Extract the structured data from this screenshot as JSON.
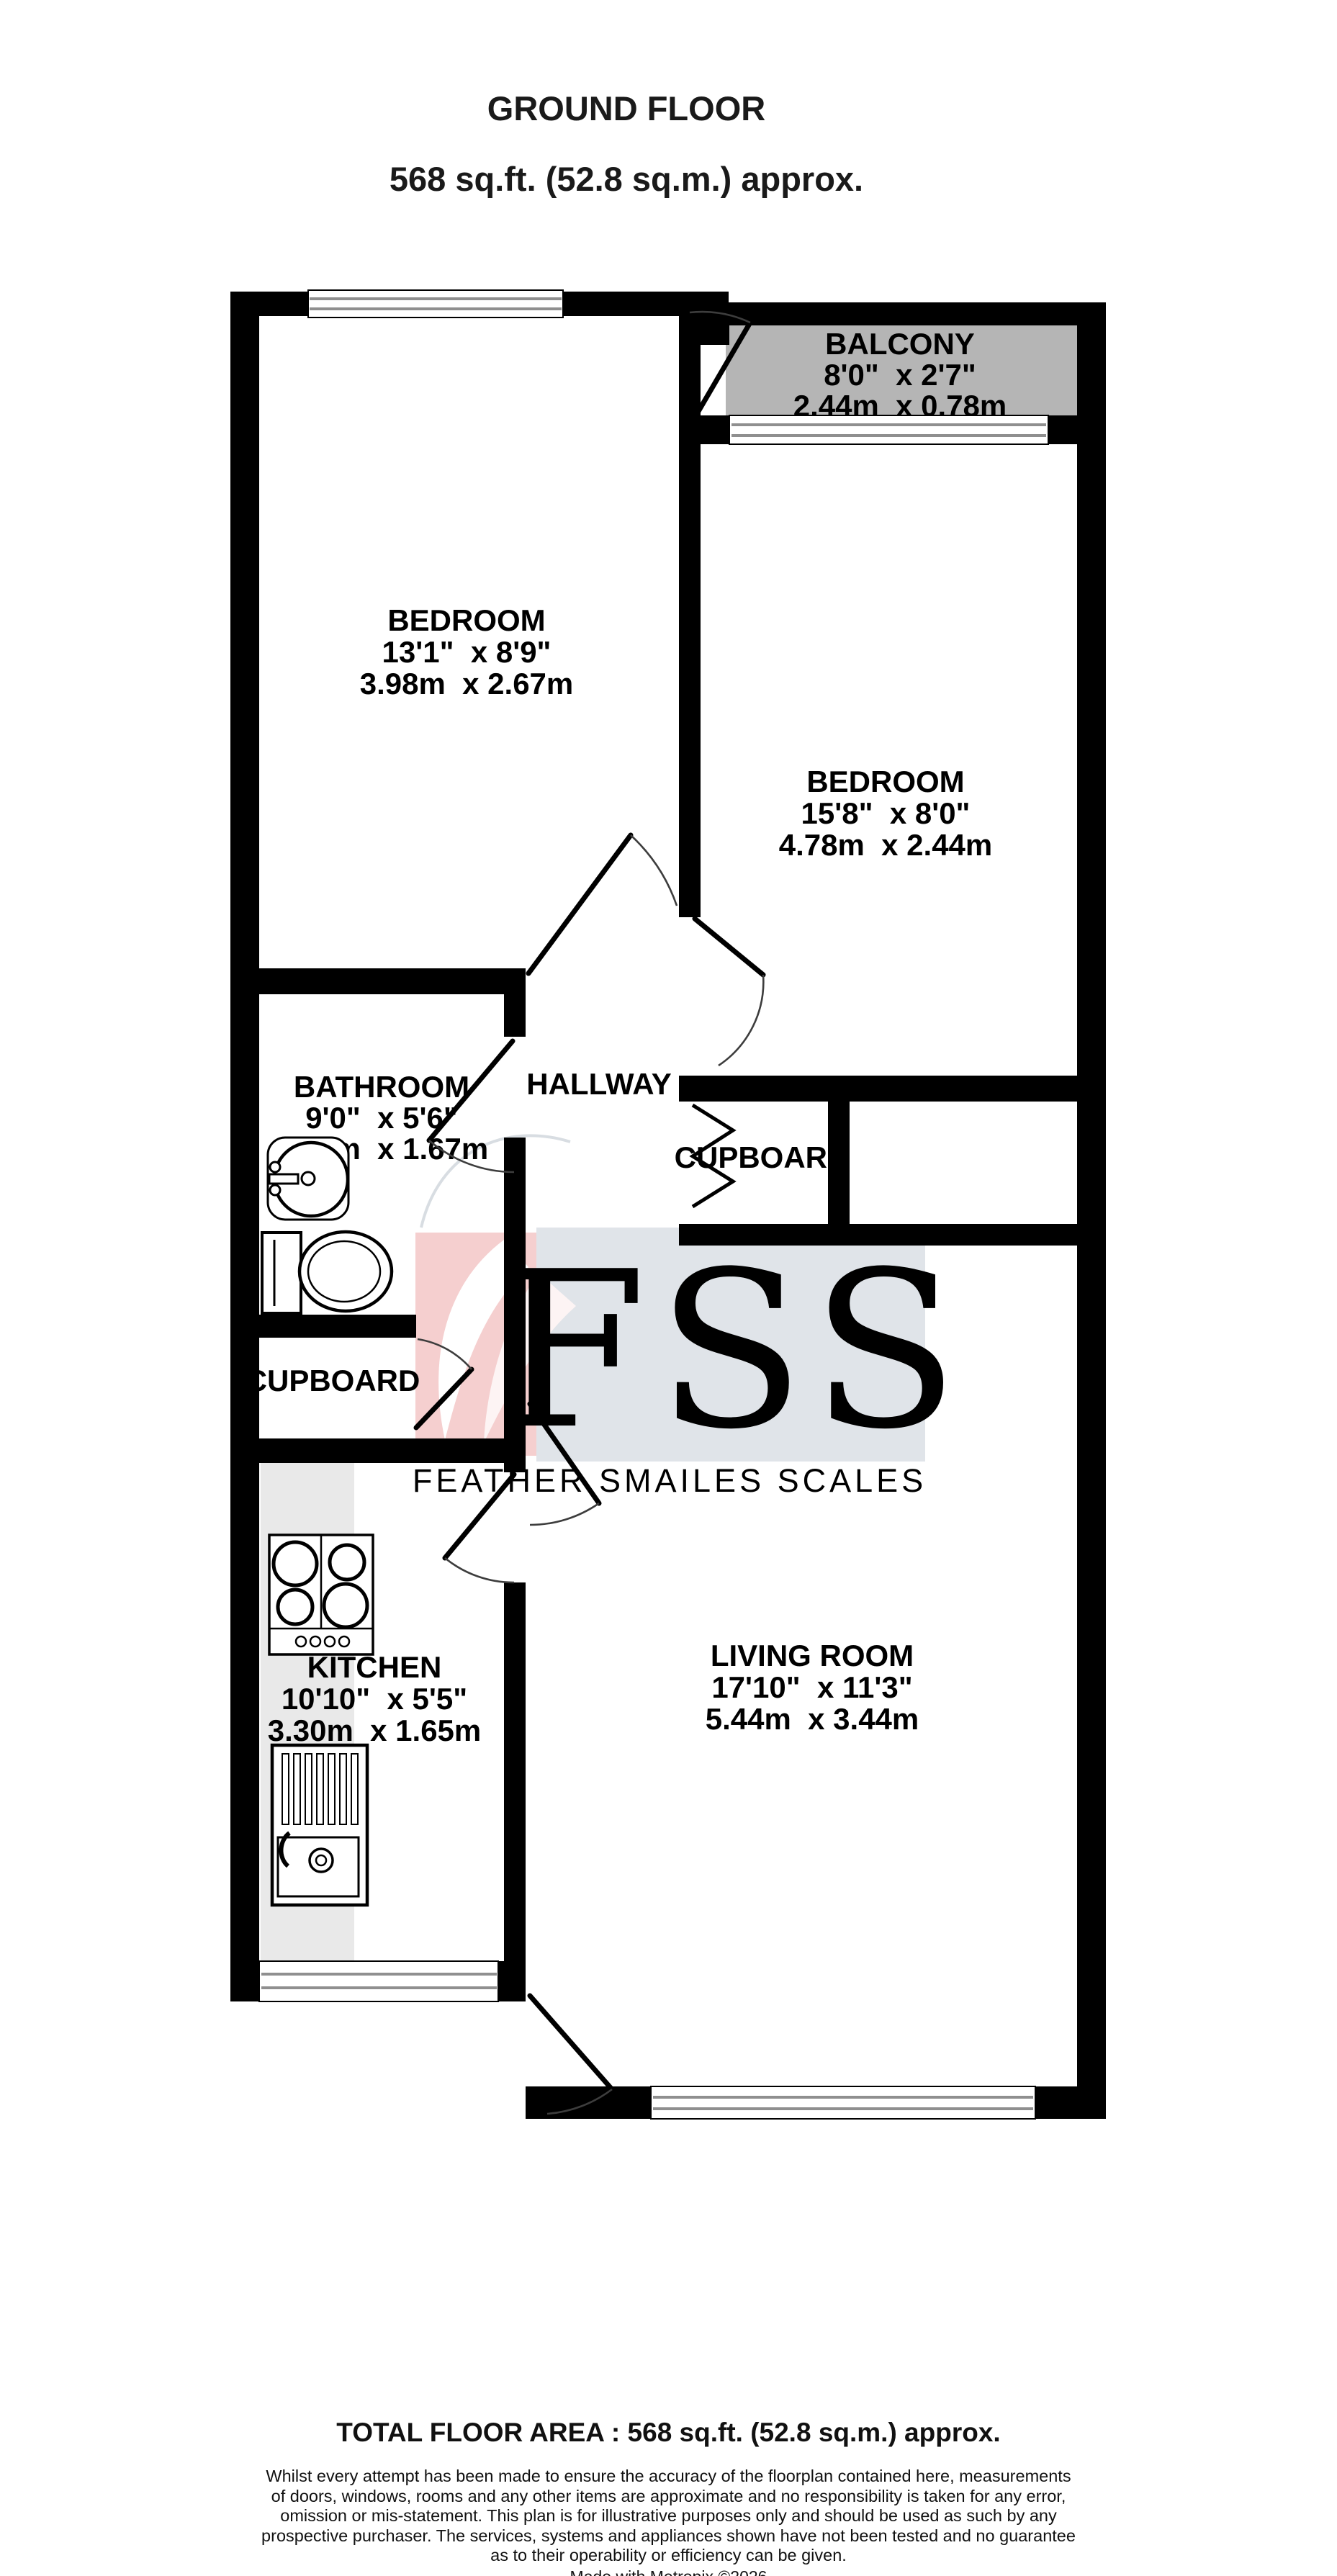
{
  "title": {
    "line1": "GROUND FLOOR",
    "line2": "568 sq.ft. (52.8 sq.m.) approx."
  },
  "rooms": {
    "balcony": {
      "name": "BALCONY",
      "imperial": "8'0\"  x 2'7\"",
      "metric": "2.44m  x 0.78m"
    },
    "bedroom_1": {
      "name": "BEDROOM",
      "imperial": "13'1\"  x 8'9\"",
      "metric": "3.98m  x 2.67m"
    },
    "bedroom_2": {
      "name": "BEDROOM",
      "imperial": "15'8\"  x 8'0\"",
      "metric": "4.78m  x 2.44m"
    },
    "bathroom": {
      "name": "BATHROOM",
      "imperial": "9'0\"  x 5'6\"",
      "metric": "2.74m  x 1.67m"
    },
    "hallway": {
      "name": "HALLWAY"
    },
    "cupboard": {
      "name": "CUPBOARD"
    },
    "cupboard_2": {
      "name": "CUPBOARD"
    },
    "kitchen": {
      "name": "KITCHEN",
      "imperial": "10'10\"  x 5'5\"",
      "metric": "3.30m  x 1.65m"
    },
    "living_room": {
      "name": "LIVING ROOM",
      "imperial": "17'10\"  x 11'3\"",
      "metric": "5.44m  x 3.44m"
    }
  },
  "watermark": {
    "initials": "FSS",
    "tagline": "FEATHER SMAILES SCALES"
  },
  "footer": {
    "total": "TOTAL FLOOR AREA : 568 sq.ft. (52.8 sq.m.) approx.",
    "disclaimer_lines": [
      "Whilst every attempt has been made to ensure the accuracy of the floorplan contained here, measurements",
      "of doors, windows, rooms and any other items are approximate and no responsibility is taken for any error,",
      "omission or mis-statement. This plan is for illustrative purposes only and should be used as such by any",
      "prospective purchaser. The services, systems and appliances shown have not been tested and no guarantee",
      "as to their operability or efficiency can be given."
    ],
    "credit": "Made with Metropix ©2026"
  },
  "colors": {
    "wall": "#000000",
    "balcony_fill": "#b5b5b5",
    "counter_fill": "#e9e9e9",
    "watermark_pink": "#f5cfcf",
    "watermark_gray": "#e0e4e9",
    "watermark_letters": "#ffffff",
    "watermark_tagline": "#ccd3db",
    "window_frame": "#8f8f8f"
  }
}
